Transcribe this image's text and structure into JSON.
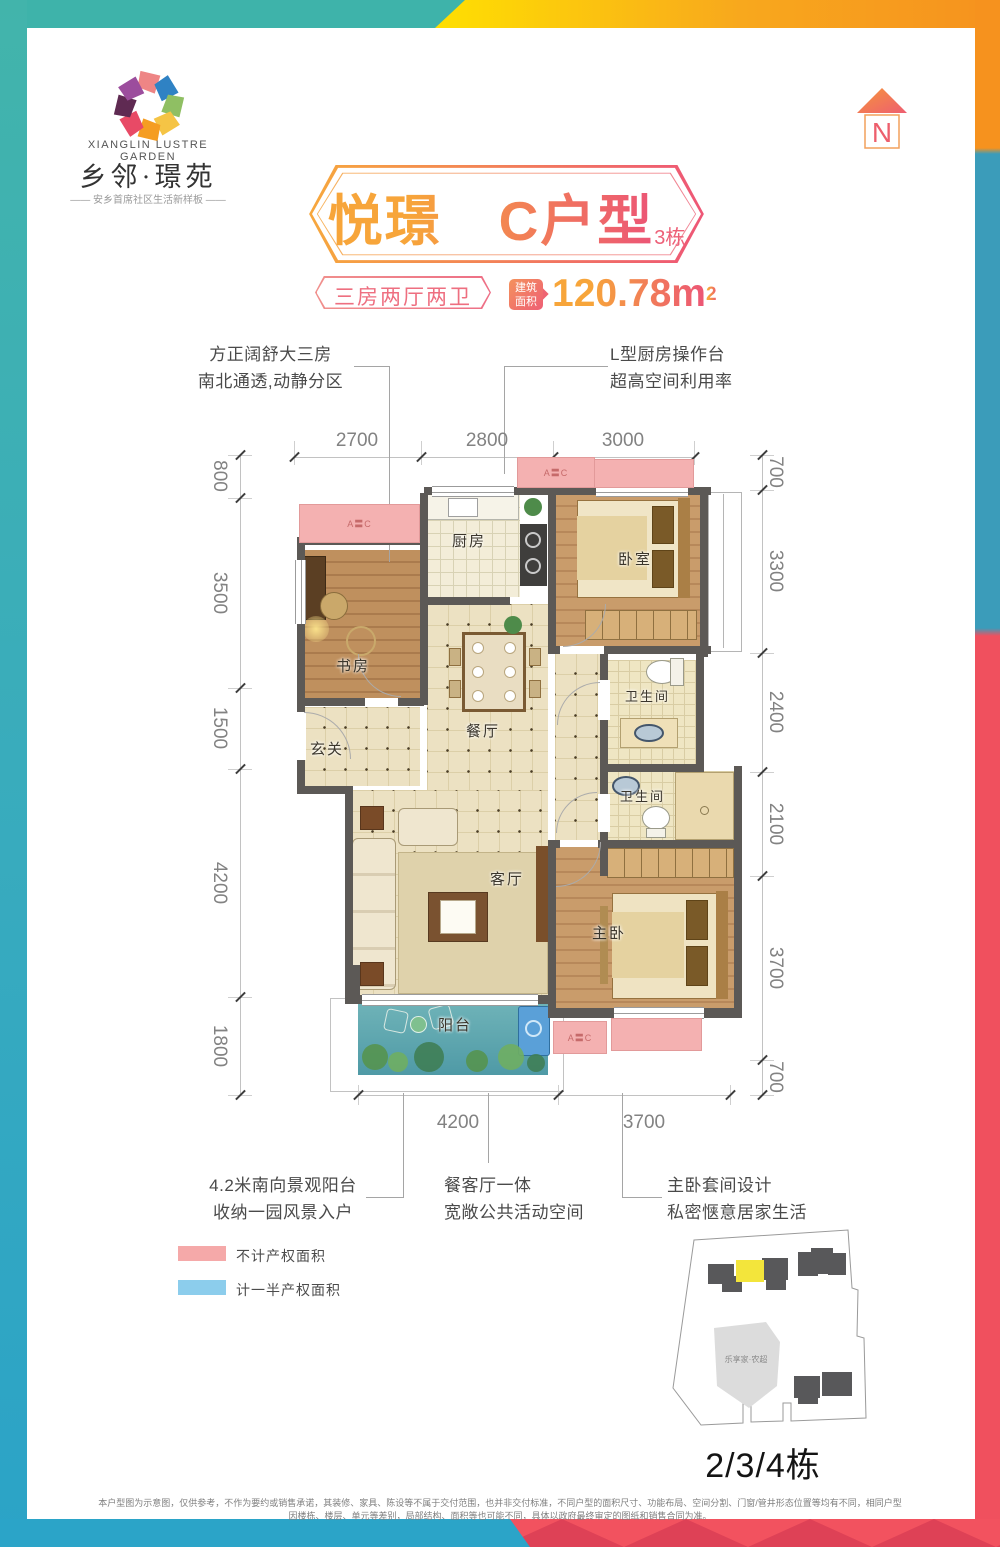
{
  "brand": {
    "name_en": "XIANGLIN  LUSTRE GARDEN",
    "name_cn": "乡邻·璟苑",
    "tagline": "—— 安乡首席社区生活新样板 ——"
  },
  "north_label": "N",
  "header": {
    "title": "悦璟　C户型",
    "building": "3栋",
    "layout_badge": "三房两厅两卫",
    "area_label_1": "建筑",
    "area_label_2": "面积",
    "area_value": "120.78m",
    "area_sup": "2"
  },
  "callouts": {
    "top_left_1": "方正阔舒大三房",
    "top_left_2": "南北通透,动静分区",
    "top_right_1": "L型厨房操作台",
    "top_right_2": "超高空间利用率",
    "bottom_left_1": "4.2米南向景观阳台",
    "bottom_left_2": "收纳一园风景入户",
    "bottom_mid_1": "餐客厅一体",
    "bottom_mid_2": "宽敞公共活动空间",
    "bottom_right_1": "主卧套间设计",
    "bottom_right_2": "私密惬意居家生活"
  },
  "floorplan": {
    "rooms": {
      "kitchen": "厨房",
      "bedroom": "卧室",
      "study": "书房",
      "dining": "餐厅",
      "foyer": "玄关",
      "living": "客厅",
      "bath1": "卫生间",
      "bath2": "卫生间",
      "master": "主卧",
      "balcony": "阳台"
    },
    "ac_label": "A〓C",
    "dims_top": [
      "2700",
      "2800",
      "3000"
    ],
    "dims_left": [
      "800",
      "3500",
      "1500",
      "4200",
      "1800"
    ],
    "dims_right": [
      "700",
      "3300",
      "2400",
      "2100",
      "3700",
      "700"
    ],
    "dims_bottom": [
      "4200",
      "3700"
    ]
  },
  "legend": {
    "item1": "不计产权面积",
    "item1_color": "#f5a9a9",
    "item2": "计一半产权面积",
    "item2_color": "#8ccdec"
  },
  "siteplan": {
    "market": "乐享家·农超",
    "caption": "2/3/4栋",
    "highlight_color": "#f3e53b"
  },
  "disclaimer": "本户型图为示意图，仅供参考，不作为要约或销售承诺，其装修、家具、陈设等不属于交付范围，也并非交付标准，不同户型的面积尺寸、功能布局、空间分割、门窗/管井形态位置等均有不同，相同户型因楼栋、楼层、单元等差别，局部结构、面积等也可能不同，具体以政府最终审定的图纸和销售合同为准。",
  "colors": {
    "teal": "#3eb3aa",
    "yellow": "#ffe200",
    "orange": "#f6921e",
    "red": "#f0505e",
    "blue": "#35a2c5"
  }
}
